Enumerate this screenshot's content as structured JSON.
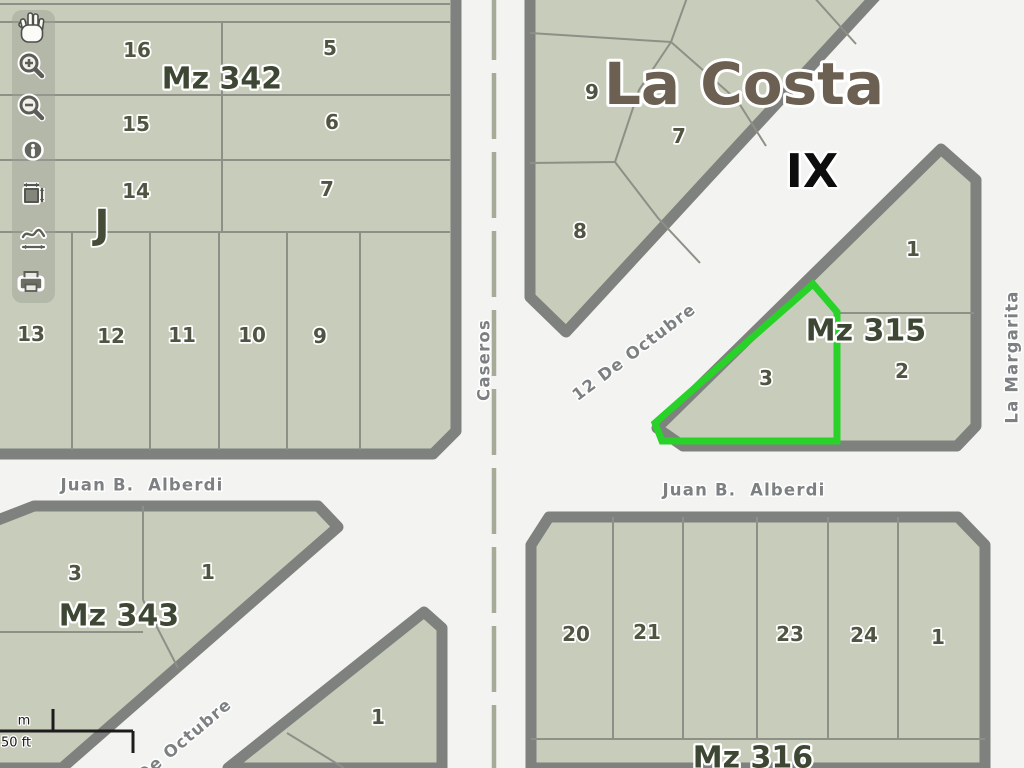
{
  "app": {
    "type": "gis-parcel-viewer"
  },
  "toolbar": {
    "tools": [
      "pan",
      "zoom-in",
      "zoom-out",
      "identify",
      "zoom-extent",
      "measure",
      "print"
    ]
  },
  "map": {
    "region": {
      "title": "La Costa",
      "zone": "IX",
      "section_marker": "J"
    },
    "streets": {
      "caseros": "Caseros",
      "doce_de_octubre": "12 De Octubre",
      "alberdi_west": "Juan B.  Alberdi",
      "alberdi_east": "Juan B.  Alberdi",
      "la_margarita": "La Margarita",
      "doce_de_octubre_south": "12 De Octubre"
    },
    "blocks": {
      "mz342": {
        "label": "Mz 342",
        "parcels": [
          "16",
          "5",
          "15",
          "6",
          "14",
          "7",
          "13",
          "12",
          "11",
          "10",
          "9"
        ]
      },
      "la_costa_block": {
        "parcels": [
          "9",
          "7",
          "8"
        ]
      },
      "mz315": {
        "label": "Mz 315",
        "parcels": [
          "1",
          "2",
          "3"
        ],
        "highlighted": "3"
      },
      "mz343": {
        "label": "Mz 343",
        "parcels": [
          "3",
          "1"
        ]
      },
      "mz316": {
        "label": "Mz 316",
        "parcels": [
          "20",
          "21",
          "23",
          "24",
          "1",
          "19"
        ]
      },
      "block_south_center": {
        "parcels": [
          "1"
        ]
      }
    },
    "scalebar": {
      "metric": "m",
      "imperial": "50 ft"
    },
    "colors": {
      "parcel_fill": "#c8ccba",
      "block_border": "#7e817d",
      "highlight": "#28d228",
      "street_bg": "#f3f3f1"
    }
  }
}
